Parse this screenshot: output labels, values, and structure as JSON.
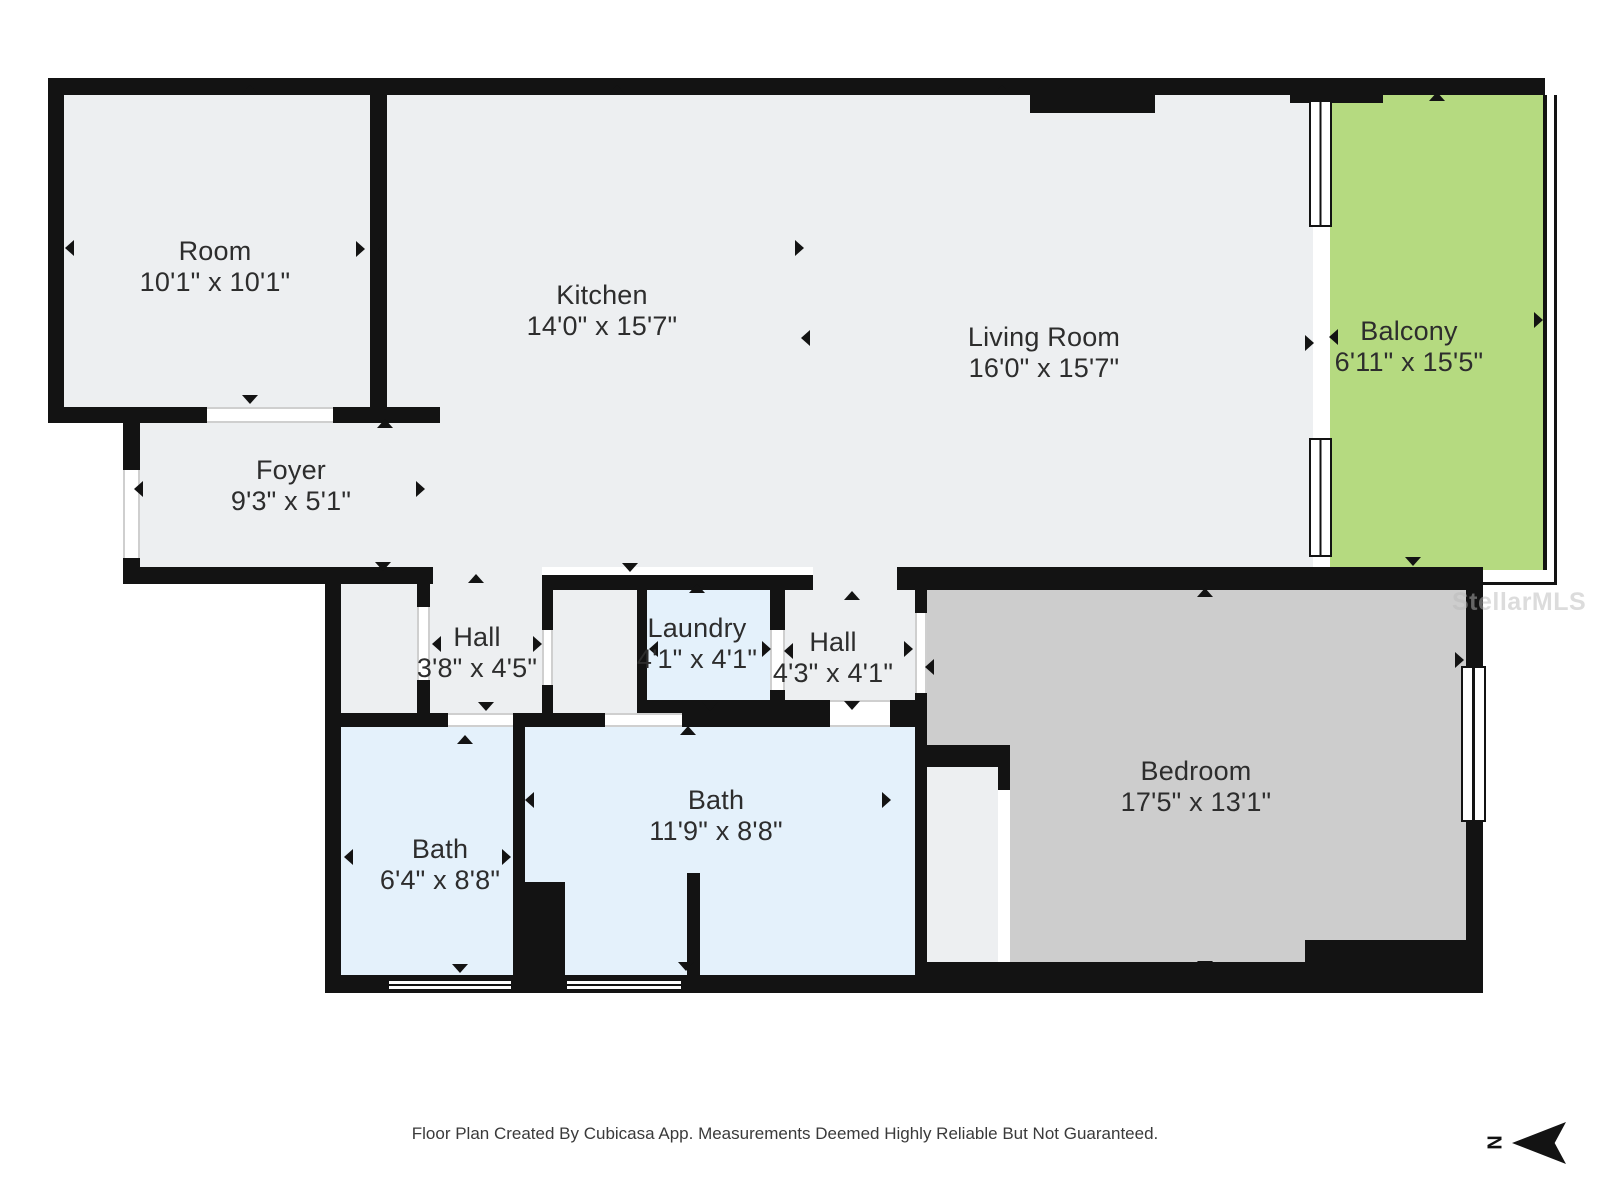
{
  "colors": {
    "wall": "#131313",
    "floor": "#edeff1",
    "wet": "#e4f1fb",
    "bedroom": "#cdcdcd",
    "balcony": "#b5da80",
    "doorline": "#cfcfcf",
    "label": "#2d2d2d"
  },
  "rooms": [
    {
      "name": "Room",
      "dims": "10'1\" x 10'1\""
    },
    {
      "name": "Kitchen",
      "dims": "14'0\" x 15'7\""
    },
    {
      "name": "Living Room",
      "dims": "16'0\" x 15'7\""
    },
    {
      "name": "Balcony",
      "dims": "6'11\" x 15'5\""
    },
    {
      "name": "Foyer",
      "dims": "9'3\" x 5'1\""
    },
    {
      "name": "Hall",
      "dims": "3'8\" x 4'5\""
    },
    {
      "name": "Laundry",
      "dims": "4'1\" x 4'1\""
    },
    {
      "name": "Hall",
      "dims": "4'3\" x 4'1\""
    },
    {
      "name": "Bath",
      "dims": "6'4\" x 8'8\""
    },
    {
      "name": "Bath",
      "dims": "11'9\" x 8'8\""
    },
    {
      "name": "Bedroom",
      "dims": "17'5\" x 13'1\""
    }
  ],
  "watermark": "StellarMLS",
  "north_label": "N",
  "footer": {
    "text": "Floor Plan Created By Cubicasa App. Measurements Deemed Highly Reliable But Not Guaranteed."
  }
}
